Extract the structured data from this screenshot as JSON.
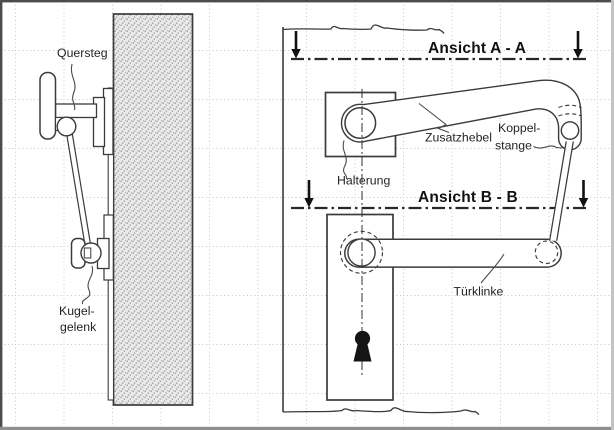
{
  "labels": {
    "quersteg": "Quersteg",
    "kugel_line1": "Kugel-",
    "kugel_line2": "gelenk",
    "ansicht_aa": "Ansicht A - A",
    "ansicht_bb": "Ansicht B - B",
    "zusatzhebel": "Zusatzhebel",
    "koppel_line1": "Koppel-",
    "koppel_line2": "stange",
    "halterung": "Halterung",
    "tuerklinke": "Türklinke"
  },
  "colors": {
    "line": "#3b3b3b",
    "text": "#242424",
    "grid_dots": "#c3c3c3",
    "door_hatch_fill": "#e9e9e9",
    "door_hatch_dot": "#9e9e9e",
    "keyhole": "#151515",
    "frame_dark": "#4c4c4c",
    "frame_bottom": "#8f8f8f",
    "frame_right": "#c2c2c2"
  }
}
